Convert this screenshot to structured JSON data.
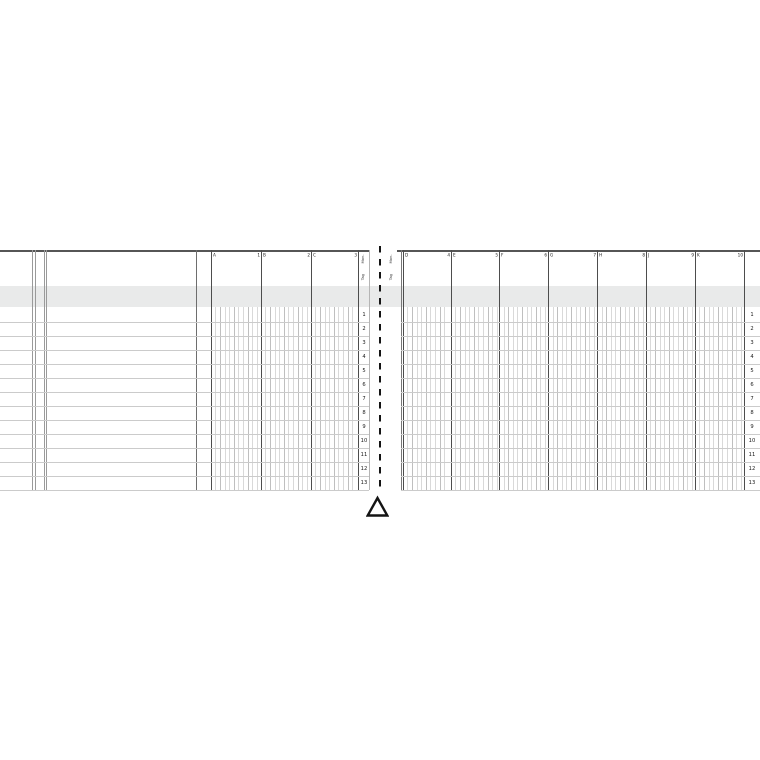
{
  "document": {
    "kind_label": "blank ledger journal two-page spread with center fold mark"
  },
  "band": {
    "color": "#e9eaea",
    "top": 286,
    "height": 21
  },
  "row_numbers": [
    "1",
    "2",
    "3",
    "4",
    "5",
    "6",
    "7",
    "8",
    "9",
    "10",
    "11",
    "12",
    "13"
  ],
  "fold": {
    "symbol": "delta-triangle",
    "color": "#141414"
  },
  "left_page": {
    "microtext": {
      "top": "Mon.",
      "bottom": "Tag"
    },
    "columns": [
      {
        "letter": "A",
        "number": "1"
      },
      {
        "letter": "B",
        "number": "2"
      },
      {
        "letter": "C",
        "number": "3"
      }
    ],
    "geom": {
      "x0": 0,
      "x1": 369,
      "verticals": [
        {
          "x": 32,
          "c": "#9a9a9a"
        },
        {
          "x": 34.5,
          "c": "#9a9a9a"
        },
        {
          "x": 43.5,
          "c": "#9a9a9a"
        },
        {
          "x": 46,
          "c": "#9a9a9a"
        },
        {
          "x": 196,
          "c": "#6e6e6e"
        },
        {
          "x": 369,
          "c": "#b5b5b5"
        }
      ],
      "money": [
        [
          211,
          261
        ],
        [
          261,
          311
        ],
        [
          311,
          358
        ]
      ],
      "row_x0": 0,
      "row_x1": 369,
      "strip_cx": 363.5,
      "micro_x": 363
    }
  },
  "right_page": {
    "microtext": {
      "top": "Mon.",
      "bottom": "Tag"
    },
    "columns": [
      {
        "letter": "D",
        "number": "4"
      },
      {
        "letter": "E",
        "number": "5"
      },
      {
        "letter": "F",
        "number": "6"
      },
      {
        "letter": "G",
        "number": "7"
      },
      {
        "letter": "H",
        "number": "8"
      },
      {
        "letter": "J",
        "number": "9"
      },
      {
        "letter": "K",
        "number": "10"
      }
    ],
    "geom": {
      "x0": 397,
      "x1": 760,
      "verticals": [
        {
          "x": 400.5,
          "c": "#777777"
        }
      ],
      "money": [
        [
          403,
          451
        ],
        [
          451,
          499.3
        ],
        [
          499.3,
          548.3
        ],
        [
          548.3,
          597.3
        ],
        [
          597.3,
          646
        ],
        [
          646,
          695
        ],
        [
          695,
          744
        ]
      ],
      "row_x0": 400.5,
      "row_x1": 760,
      "strip_cx": 751.5,
      "micro_x": 391
    }
  },
  "layout": {
    "top": 250,
    "bottom": 490,
    "band_bottom": 307,
    "rows_top": 308,
    "row_h": 14,
    "hair_step": 4.6,
    "border_w": 1.5,
    "fold_x": 378.7,
    "fold_top": 246,
    "fold_bottom": 492,
    "header_label_y": 252.5,
    "c_border": "#565656",
    "c_heavy": "#4d4d4d",
    "c_hair": "#d9d9d9",
    "c_hair2": "#bfbfbf",
    "c_row": "#cbcbcb",
    "c_text": "#1a1a1a",
    "c_micro": "#333333"
  }
}
